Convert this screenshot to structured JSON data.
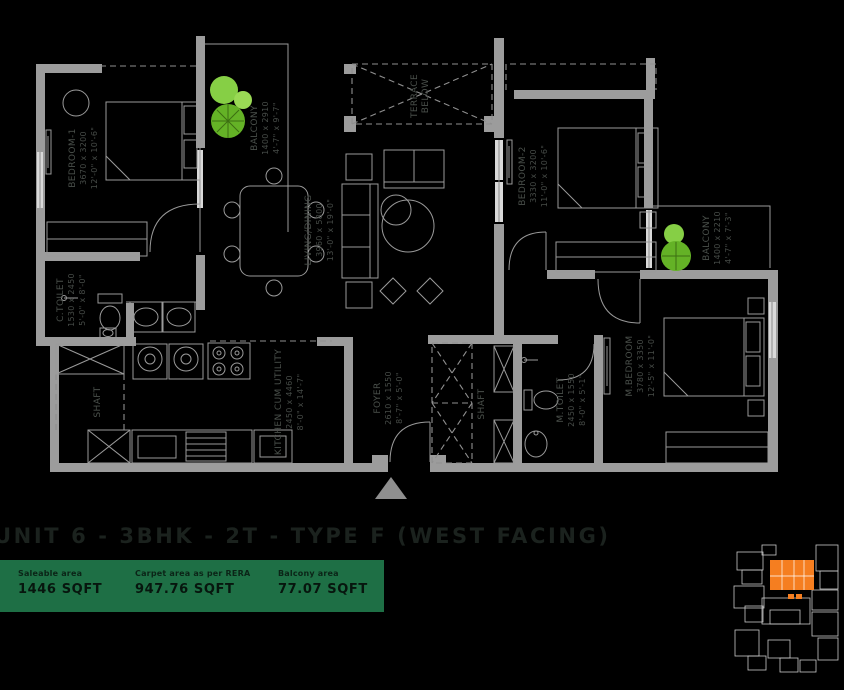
{
  "header": {
    "title": "UNIT 6 - 3BHK - 2T - TYPE F (WEST FACING)"
  },
  "stats": {
    "bar_color": "#1e6f45",
    "items": [
      {
        "label": "Saleable area",
        "value": "1446 SQFT"
      },
      {
        "label": "Carpet area as per RERA",
        "value": "947.76 SQFT"
      },
      {
        "label": "Balcony area",
        "value": "77.07 SQFT"
      }
    ]
  },
  "floor_plan": {
    "rooms": {
      "bedroom1": {
        "name": "BEDROOM-1",
        "dim_mm": "3670 x 3200",
        "dim_ft": "12'-0\" x 10'-6\""
      },
      "balcony1": {
        "name": "BALCONY",
        "dim_mm": "1400 x 2910",
        "dim_ft": "4'-7\" x 9'-7\""
      },
      "terrace": {
        "name": "TERRACE",
        "name2": "BELOW"
      },
      "living": {
        "name": "LIVING/DINING",
        "dim_mm": "3960 x 5800",
        "dim_ft": "13'-0\" x 19'-0\""
      },
      "bedroom2": {
        "name": "BEDROOM-2",
        "dim_mm": "3330 x 3200",
        "dim_ft": "11'-0\" x 10'-6\""
      },
      "balcony2": {
        "name": "BALCONY",
        "dim_mm": "1400 x 2210",
        "dim_ft": "4'-7\" x 7'-3\""
      },
      "m_bedroom": {
        "name": "M.BEDROOM",
        "dim_mm": "3780 x 3350",
        "dim_ft": "12'-5\" x 11'-0\""
      },
      "m_toilet": {
        "name": "M.TOILET",
        "dim_mm": "2450 x 1550",
        "dim_ft": "8'-0\" x 5'-1\""
      },
      "c_toilet": {
        "name": "C.TOILET",
        "dim_mm": "1530 x 2450",
        "dim_ft": "5'-0\" x 8'-0\""
      },
      "kitchen": {
        "name": "KITCHEN CUM UTILITY",
        "dim_mm": "2450 x 4460",
        "dim_ft": "8'-0\" x 14'-7\""
      },
      "foyer": {
        "name": "FOYER",
        "dim_mm": "2610 x 1550",
        "dim_ft": "8'-7\" x 5'-0\""
      },
      "shaft_left": {
        "name": "SHAFT"
      },
      "shaft_center": {
        "name": "SHAFT"
      }
    },
    "colors": {
      "wall": "#9c9c9c",
      "line": "#9a9a9a",
      "label": "#474c48",
      "tree_dark": "#64b226",
      "tree_light": "#86cf45"
    }
  },
  "key_plan": {
    "highlight_color": "#f57e20"
  }
}
